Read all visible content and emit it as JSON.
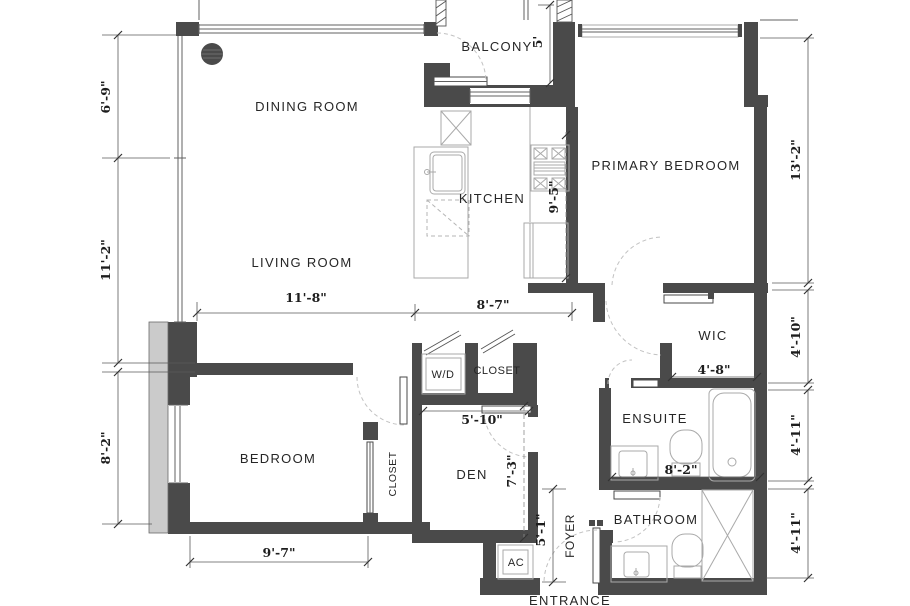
{
  "floorplan": {
    "rooms": {
      "dining_room": "DINING ROOM",
      "balcony": "BALCONY",
      "kitchen": "KITCHEN",
      "primary_bedroom": "PRIMARY BEDROOM",
      "living_room": "LIVING ROOM",
      "wic": "WIC",
      "ensuite": "ENSUITE",
      "bedroom": "BEDROOM",
      "bedroom_closet": "CLOSET",
      "hall_closet": "CLOSET",
      "washer_dryer": "W/D",
      "den": "DEN",
      "bathroom": "BATHROOM",
      "foyer": "FOYER",
      "entrance": "ENTRANCE",
      "ac_unit": "AC"
    },
    "dimensions": {
      "dining_depth": "6'-9\"",
      "living_depth": "11'-2\"",
      "bedroom_depth": "8'-2\"",
      "primary_depth": "13'-2\"",
      "wic_depth": "4'-10\"",
      "ensuite_depth": "4'-11\"",
      "bathroom_depth": "4'-11\"",
      "living_width": "11'-8\"",
      "kitchen_width": "8'-7\"",
      "kitchen_depth": "9'-5\"",
      "balcony_depth": "5'",
      "wic_width": "4'-8\"",
      "ensuite_width": "8'-2\"",
      "den_width": "5'-10\"",
      "den_depth": "7'-3\"",
      "foyer_depth": "5'-1\"",
      "bedroom_width": "9'-7\""
    },
    "colors": {
      "wall": "#4a4a4a",
      "concrete": "#cbcbcb",
      "line": "#5a5a5a",
      "fixture": "#a9a9a9",
      "swing_arc": "#c2c2c2",
      "text": "#262626"
    }
  }
}
